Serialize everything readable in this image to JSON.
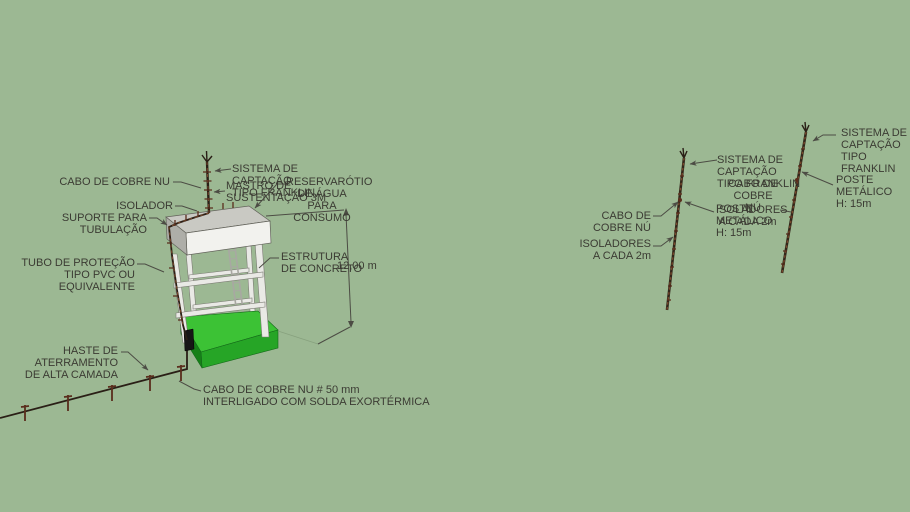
{
  "scene": {
    "app": "3d-model-view",
    "description": "Water reservoir tower and metallic poles with lightning protection system annotations"
  },
  "colors": {
    "bg": "#9cb893",
    "text": "#3b3b33",
    "line": "#4c4c44",
    "ground": "#87a17e",
    "cable": "#2a1f16",
    "rod": "#5a2d1c",
    "pole": "#32261a",
    "poleseg": "#7a4a2c",
    "tanktop": "#c9c9c3",
    "tankfront": "#f2f2ee",
    "tankside": "#aeaea8",
    "tankedge": "#62625a",
    "column": "#e9e9e5",
    "columnedge": "#7c7c74",
    "ladder": "#a8a8a2",
    "basetop": "#3cc235",
    "basefront": "#26a526",
    "baseside": "#168018",
    "baseedge": "#14691a"
  },
  "tower": {
    "labels": {
      "cabo_cobre_nu": "CABO DE COBRE NU",
      "isolador": "ISOLADOR",
      "suporte": "SUPORTE PARA TUBULAÇÃO",
      "tubo_protecao": "TUBO DE PROTEÇÃO\nTIPO PVC OU EQUIVALENTE",
      "sistema_captacao": "SISTEMA DE\nCAPTAÇÃO\nTIPO FRANKLIN",
      "mastro": "MASTRO DE\nSUSTENTAÇÃO 3M",
      "reservatorio": "RESERVARÓTIO\nDE ÁGUA\nPARA CONSUMO",
      "estrutura": "ESTRUTURA\nDE CONCRETO",
      "altura": "12,00 m",
      "haste": "HASTE DE\nATERRAMENTO\nDE ALTA CAMADA",
      "cabo_50mm": "CABO DE COBRE NU # 50 mm\nINTERLIGADO COM SOLDA EXORTÉRMICA"
    }
  },
  "pole1": {
    "labels": {
      "cabo_left": "CABO DE\nCOBRE NÚ",
      "isoladores_left": "ISOLADORES\nA CADA 2m",
      "sistema": "SISTEMA DE\nCAPTAÇÃO\nTIPO FRANKLIN",
      "cabo_overlay": "CABO DE\nCOBRE NÚ",
      "poste": "POSTE\nMETÁLICO\nH: 15m",
      "isoladores_overlay": "ISOLADORES\nA CADA 2m"
    }
  },
  "pole2": {
    "labels": {
      "sistema": "SISTEMA DE\nCAPTAÇÃO\nTIPO FRANKLIN",
      "poste": "POSTE\nMETÁLICO\nH: 15m"
    }
  }
}
